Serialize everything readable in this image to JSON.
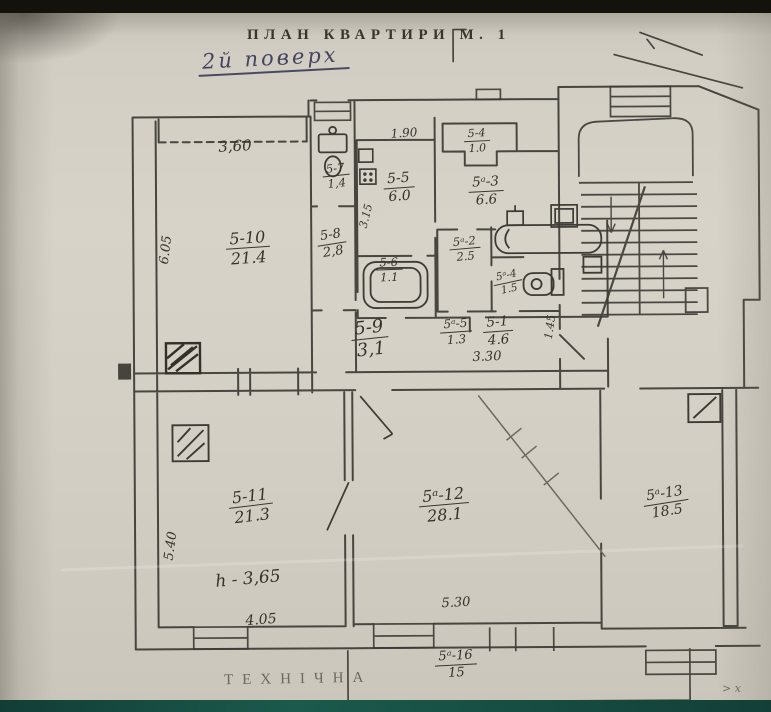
{
  "title": "ПЛАН КВАРТИРИ М. 1",
  "subtitle_handwritten": "2й поверх",
  "footer": "ТЕХНІЧНА",
  "corner_mark": "> х",
  "colors": {
    "paper": "#d2cec4",
    "ink": "#3c3a34",
    "pencil": "#5b5749",
    "handwriting_blue": "#45445e",
    "photo_top_bar": "#14120d",
    "photo_bottom_bar": "#17493f"
  },
  "rooms": [
    {
      "number": "5-10",
      "area": "21.4"
    },
    {
      "number": "5-7",
      "area": "1,4"
    },
    {
      "number": "5-8",
      "area": "2,8"
    },
    {
      "number": "5-5",
      "area": "6.0"
    },
    {
      "number": "5-4",
      "area": "1.0"
    },
    {
      "number": "5ᵃ-3",
      "area": "6.6"
    },
    {
      "number": "5ᵃ-2",
      "area": "2.5"
    },
    {
      "number": "5-6",
      "area": "1.1"
    },
    {
      "number": "5-9",
      "area": "3,1"
    },
    {
      "number": "5ᵃ-5",
      "area": "1.3"
    },
    {
      "number": "5-1",
      "area": "4.6"
    },
    {
      "number": "5ᵃ-4",
      "area": "1.5"
    },
    {
      "number": "5-11",
      "area": "21.3"
    },
    {
      "number": "5ᵃ-12",
      "area": "28.1"
    },
    {
      "number": "5ᵃ-13",
      "area": "18.5"
    },
    {
      "number": "5ᵃ-16",
      "area": "15"
    }
  ],
  "dims": [
    {
      "value": "3,60"
    },
    {
      "value": "6.05"
    },
    {
      "value": "1.90"
    },
    {
      "value": "3.15"
    },
    {
      "value": "3.30"
    },
    {
      "value": "1.45"
    },
    {
      "value": "5.40"
    },
    {
      "value": "4.05"
    },
    {
      "value": "5.30"
    },
    {
      "value": "h - 3,65"
    }
  ]
}
